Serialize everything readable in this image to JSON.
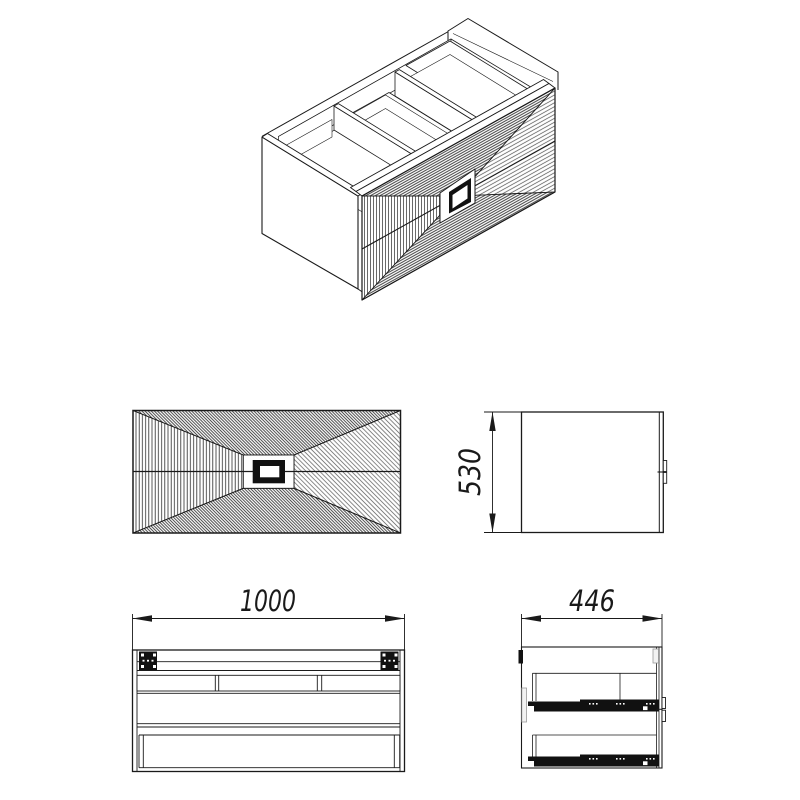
{
  "drawing": {
    "type": "furniture technical drawing",
    "subject": "wall-hung two-drawer vanity cabinet",
    "colors": {
      "background": "#ffffff",
      "line": "#1a1a1a",
      "hatch_dark": "#2a2a2a",
      "hatch_light": "#4a4a4a",
      "hardware_black": "#111111"
    },
    "dimensions": {
      "width": "1000",
      "depth": "446",
      "height": "530"
    },
    "views": {
      "isometric": "isometric projection, open top, hatched drawer fronts with central recessed handle",
      "front": "front elevation of drawer fronts, four hatched fields converging on handle",
      "side": "side elevation with height dimension",
      "carcass_front": "front view of carcass with hanging brackets",
      "section_side": "side section with two drawer slides"
    }
  }
}
